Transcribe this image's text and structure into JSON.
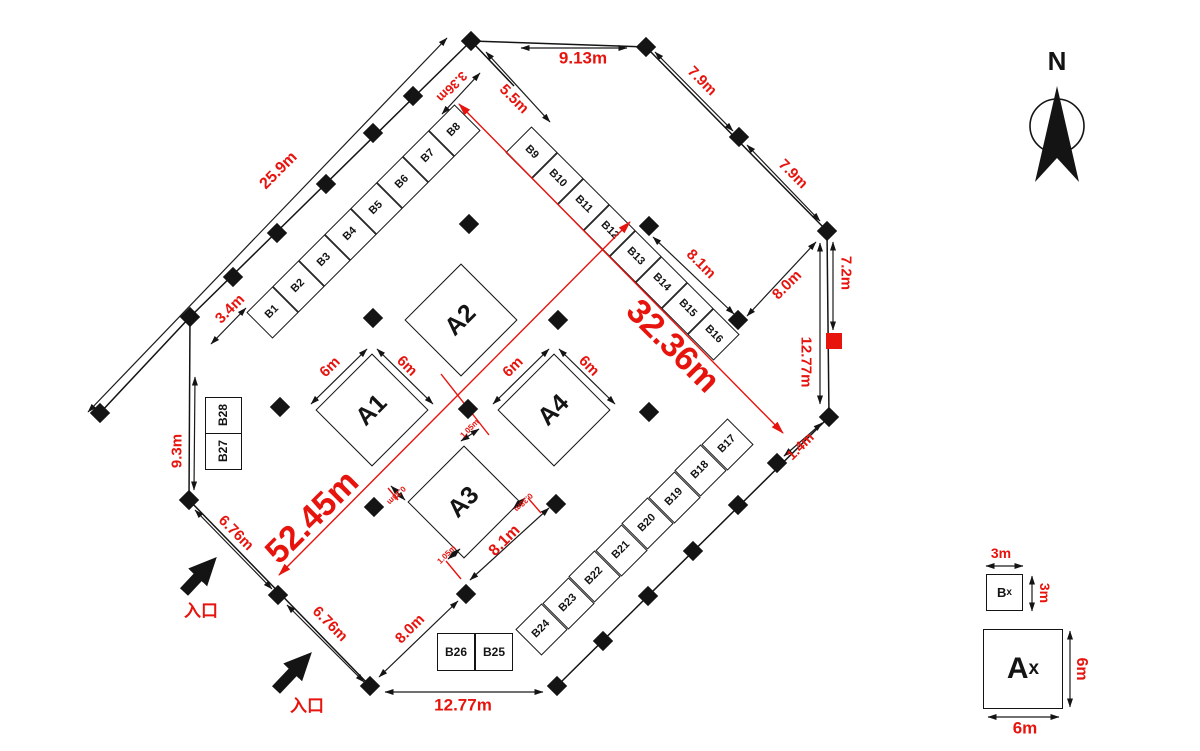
{
  "north_label": "N",
  "entrance_labels": [
    "入口",
    "入口"
  ],
  "booths_a": [
    "A1",
    "A2",
    "A3",
    "A4"
  ],
  "booths_b": [
    "B1",
    "B2",
    "B3",
    "B4",
    "B5",
    "B6",
    "B7",
    "B8",
    "B9",
    "B10",
    "B11",
    "B12",
    "B13",
    "B14",
    "B15",
    "B16",
    "B17",
    "B18",
    "B19",
    "B20",
    "B21",
    "B22",
    "B23",
    "B24",
    "B25",
    "B26",
    "B27",
    "B28"
  ],
  "legend": {
    "b_letter": "B",
    "b_sub": "x",
    "b_top": "3m",
    "b_side": "3m",
    "a_letter": "A",
    "a_sub": "x",
    "a_side": "6m",
    "a_bottom": "6m"
  },
  "dims": {
    "d25_9": "25.9m",
    "d3_4": "3.4m",
    "d9_3": "9.3m",
    "d3_36": "3.36m",
    "d9_13": "9.13m",
    "d5_5": "5.5m",
    "d7_9a": "7.9m",
    "d7_9b": "7.9m",
    "d8_1_ne": "8.1m",
    "d8_0_ne": "8.0m",
    "d7_2": "7.2m",
    "d12_77_e": "12.77m",
    "d1_4": "1.4m",
    "d32_36": "32.36m",
    "d52_45": "52.45m",
    "d6_a1l": "6m",
    "d6_a1r": "6m",
    "d6_a4l": "6m",
    "d6_a4r": "6m",
    "d8_1_a3": "8.1m",
    "d1_05_t": "1.05m",
    "d1_05_b": "1.05m",
    "d0_38_l": "0.38m",
    "d0_38_r": "0.38m",
    "d6_76_a": "6.76m",
    "d6_76_b": "6.76m",
    "d8_0_sw": "8.0m",
    "d12_77_s": "12.77m"
  },
  "colors": {
    "red": "#e7140e",
    "ink": "#141414"
  }
}
